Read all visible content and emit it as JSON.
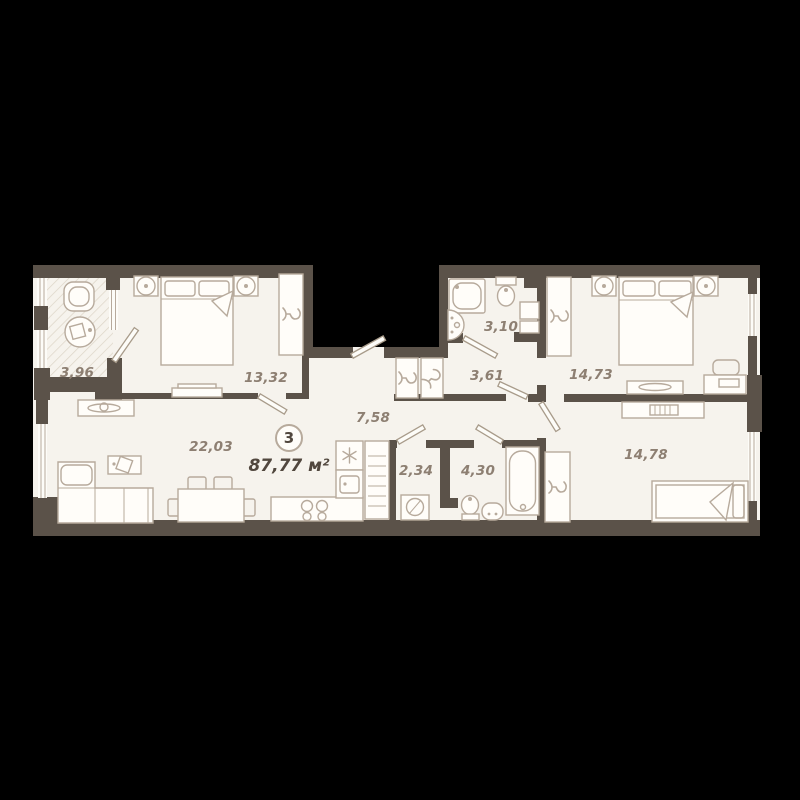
{
  "title": "apartment-floor-plan",
  "badge": {
    "number": "3",
    "total_area": "87,77 м²"
  },
  "rooms": {
    "balcony": {
      "name": "balcony",
      "area": "3,96"
    },
    "bedroom_main": {
      "name": "bedroom",
      "area": "13,32"
    },
    "bathroom_small": {
      "name": "bathroom",
      "area": "3,10"
    },
    "bedroom_right": {
      "name": "bedroom",
      "area": "14,73"
    },
    "hallway": {
      "name": "hallway",
      "area": "3,61"
    },
    "corridor": {
      "name": "corridor",
      "area": "7,58"
    },
    "living_kitchen": {
      "name": "living-kitchen",
      "area": "22,03"
    },
    "laundry": {
      "name": "laundry",
      "area": "2,34"
    },
    "bathroom_large": {
      "name": "bathroom",
      "area": "4,30"
    },
    "bedroom_third": {
      "name": "bedroom",
      "area": "14,78"
    }
  },
  "colors": {
    "bg": "#000000",
    "wall": "#5b5249",
    "floor": "#f6f3ed",
    "line": "#b7aa9c",
    "label": "#8d7f72",
    "dark": "#51473e",
    "hatch": "#dcd4c6"
  }
}
